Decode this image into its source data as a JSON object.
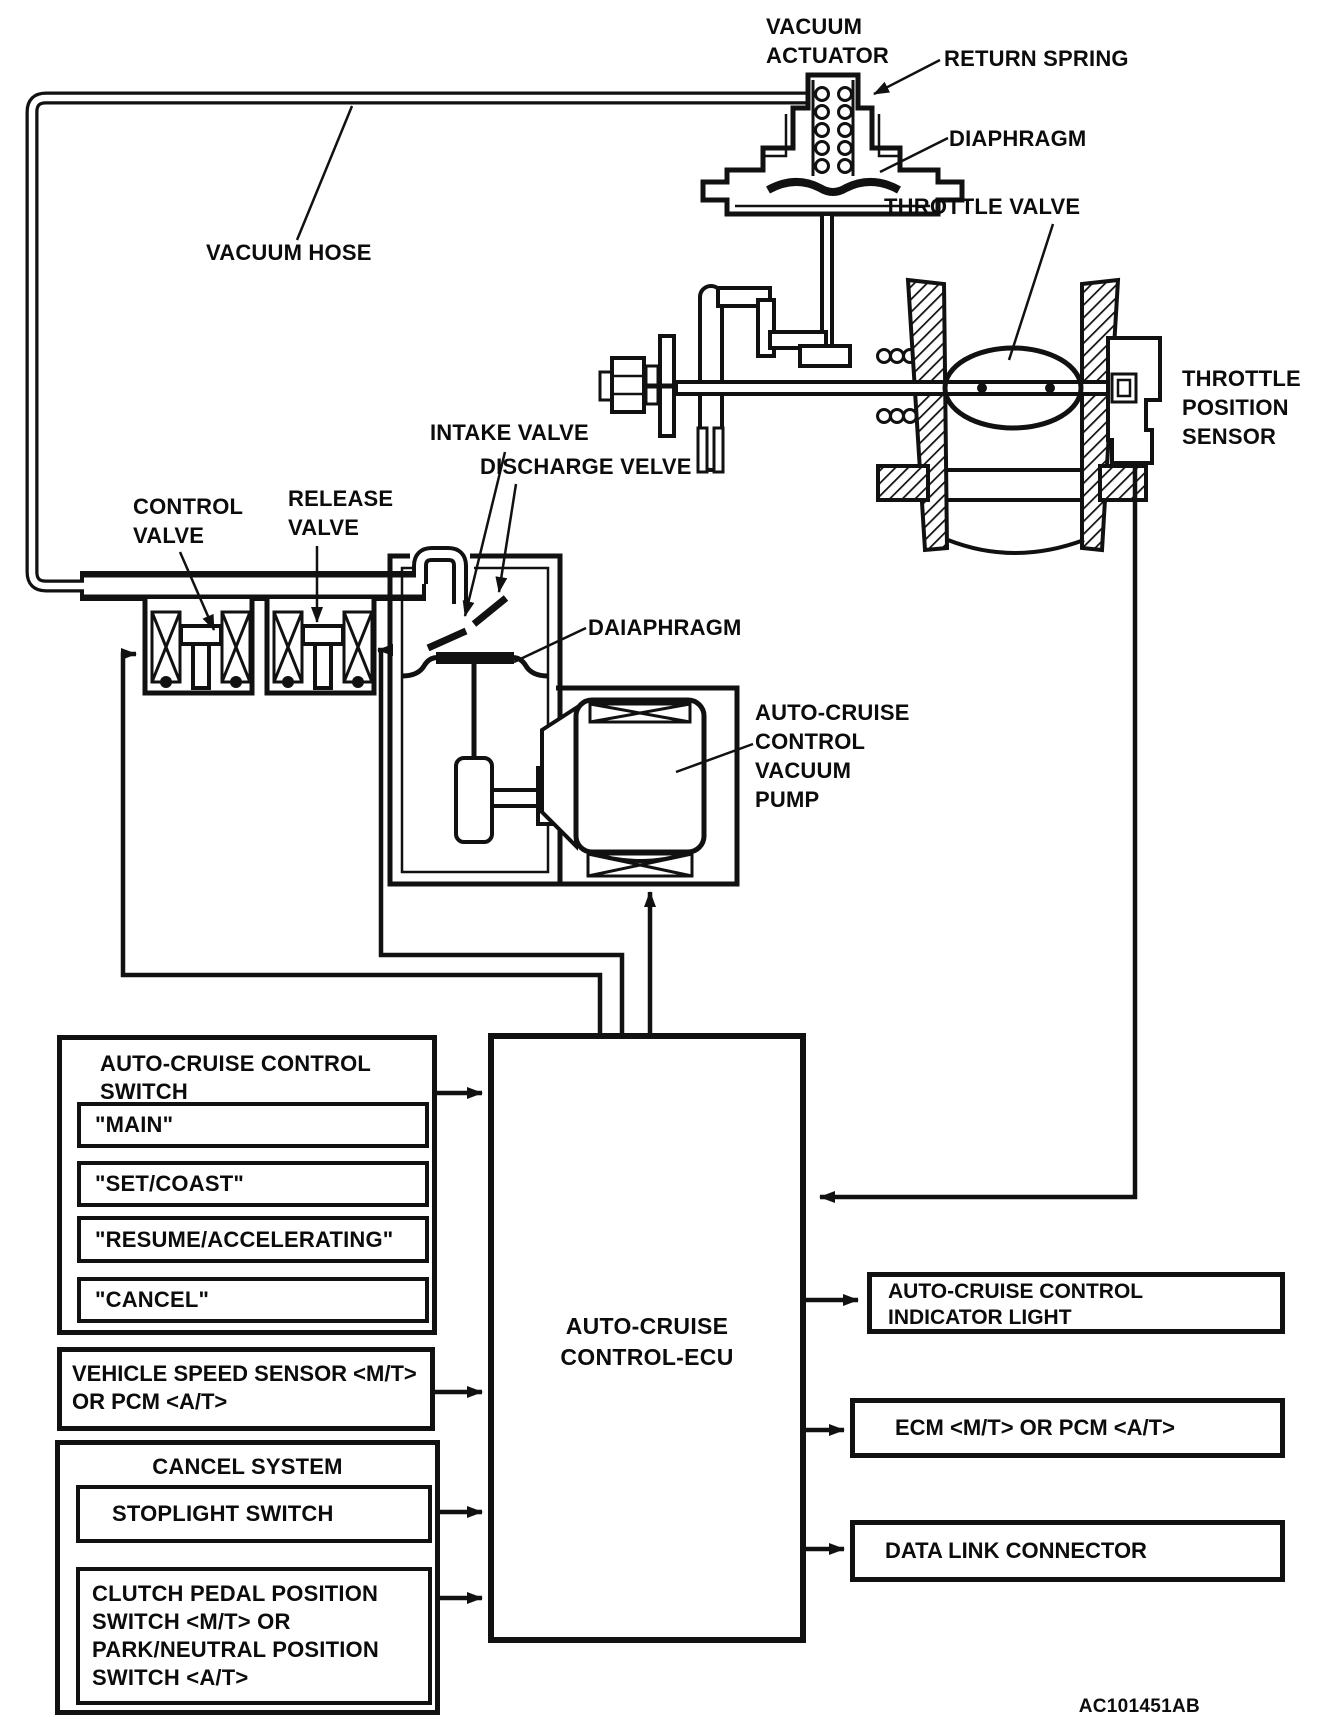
{
  "diagram": {
    "part_code": "AC101451AB",
    "labels": {
      "vacuum_actuator_1": "VACUUM",
      "vacuum_actuator_2": "ACTUATOR",
      "return_spring": "RETURN SPRING",
      "diaphragm": "DIAPHRAGM",
      "throttle_valve": "THROTTLE VALVE",
      "tps_1": "THROTTLE",
      "tps_2": "POSITION",
      "tps_3": "SENSOR",
      "vacuum_hose": "VACUUM HOSE",
      "intake_valve": "INTAKE VALVE",
      "discharge_valve": "DISCHARGE VELVE",
      "control_valve_1": "CONTROL",
      "control_valve_2": "VALVE",
      "release_valve_1": "RELEASE",
      "release_valve_2": "VALVE",
      "pump_diaphragm": "DAIAPHRAGM",
      "vacuum_pump_1": "AUTO-CRUISE",
      "vacuum_pump_2": "CONTROL",
      "vacuum_pump_3": "VACUUM",
      "vacuum_pump_4": "PUMP"
    },
    "ecu": {
      "line1": "AUTO-CRUISE",
      "line2": "CONTROL-ECU"
    },
    "switch_box": {
      "title_1": "AUTO-CRUISE CONTROL",
      "title_2": "SWITCH",
      "buttons": [
        "\"MAIN\"",
        "\"SET/COAST\"",
        "\"RESUME/ACCELERATING\"",
        "\"CANCEL\""
      ]
    },
    "vehicle_speed": {
      "line1": "VEHICLE SPEED SENSOR <M/T>",
      "line2": "OR PCM <A/T>"
    },
    "cancel_system": {
      "title": "CANCEL SYSTEM",
      "stoplight": "STOPLIGHT SWITCH",
      "clutch_1": "CLUTCH PEDAL POSITION",
      "clutch_2": "SWITCH <M/T> OR",
      "clutch_3": "PARK/NEUTRAL POSITION",
      "clutch_4": "SWITCH <A/T>"
    },
    "outputs": {
      "indicator_1": "AUTO-CRUISE CONTROL",
      "indicator_2": "INDICATOR LIGHT",
      "ecm": "ECM <M/T> OR PCM <A/T>",
      "dlc": "DATA LINK CONNECTOR"
    }
  }
}
